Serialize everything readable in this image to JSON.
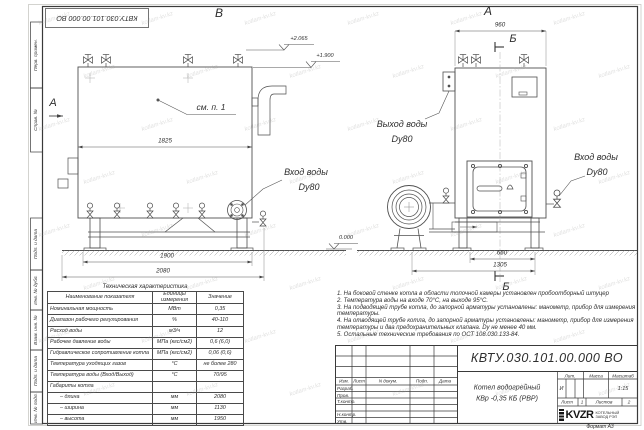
{
  "watermark": "kotlam-kv.kz",
  "doc": {
    "number": "КВТУ.030.101.00.000  ВО"
  },
  "frame_labels": [
    "Перв. примен.",
    "Справ. №",
    "Подп. и дата",
    "Инв. № дубл.",
    "Взам. инв. №",
    "Подп. и дата",
    "Инв. № подл."
  ],
  "labels": {
    "view_front": "В",
    "view_side": "А",
    "section_a": "А",
    "section_b": "Б",
    "see_note": "см. п. 1",
    "water_in": "Вход воды",
    "water_out": "Выход воды",
    "dn": "Dy80"
  },
  "dims": {
    "body_width": "1825",
    "frame_width": "1900",
    "total_width": "2080",
    "depth": "960",
    "frame_depth": "660",
    "total_depth": "1305"
  },
  "levels": {
    "valves_top": "+2.065",
    "body_top": "+1.900",
    "ground": "0.000"
  },
  "spec_table": {
    "title": "Техническая характеристика",
    "headers": [
      "Наименование показателя",
      "Единицы измерения",
      "Значение"
    ],
    "rows": [
      [
        "Номинальная мощность",
        "МВт",
        "0,35"
      ],
      [
        "Диапазон рабочего регулирования",
        "%",
        "40-110"
      ],
      [
        "Расход воды",
        "м3/ч",
        "12"
      ],
      [
        "Рабочее давление воды",
        "МПа (кгс/см2)",
        "0,6 (6,0)"
      ],
      [
        "Гидравлическое сопротивление котла",
        "МПа (кгс/см2)",
        "0,06 (0,6)"
      ],
      [
        "Температура уходящих газов",
        "°С",
        "не более 280"
      ],
      [
        "Температура воды (Вход/Выход)",
        "°С",
        "70/95"
      ],
      [
        "Габариты котла",
        "",
        ""
      ],
      [
        "– длина",
        "мм",
        "2080"
      ],
      [
        "– ширина",
        "мм",
        "1130"
      ],
      [
        "– высота",
        "мм",
        "1950"
      ]
    ]
  },
  "notes": [
    "1.  На боковой стенке котла в области топочной камеры установлен пробоотборный штуцер",
    "2.  Температура воды на входе 70°С, на выходе 95°С.",
    "3.  На подводящей трубе котла, до запорной арматуры установлены: манометр, прибор для измерения температуры.",
    "4.  На отводящей трубе котла, до запорной арматуры установлены: манометр, прибор для измерения температуры и два предохранительных клапана. Dу не менее 40 мм.",
    "5.  Остальные технические требования по ОСТ 108.030.133-84."
  ],
  "title_block": {
    "product_line1": "Котел водогрейный",
    "product_line2": "КВр -0,35  КБ  (РВР)",
    "cols": [
      "Изм.",
      "Лист",
      "N докум.",
      "Подп.",
      "Дата"
    ],
    "rows": [
      "Разраб.",
      "Пров.",
      "Т.контр.",
      "Н.контр.",
      "Утв."
    ],
    "lit_label": "Лит.",
    "mass_label": "Масса",
    "scale_label": "Масштаб",
    "lit_value": "И",
    "scale_value": "1:15",
    "sheet_label": "Лист",
    "sheet_value": "1",
    "sheets_label": "Листов",
    "sheets_value": "2",
    "logo_text": "KVZR",
    "logo_caption1": "КОТЕЛЬНЫЙ",
    "logo_caption2": "ЗАВОД РЭП",
    "format_label": "Формат   А3"
  }
}
